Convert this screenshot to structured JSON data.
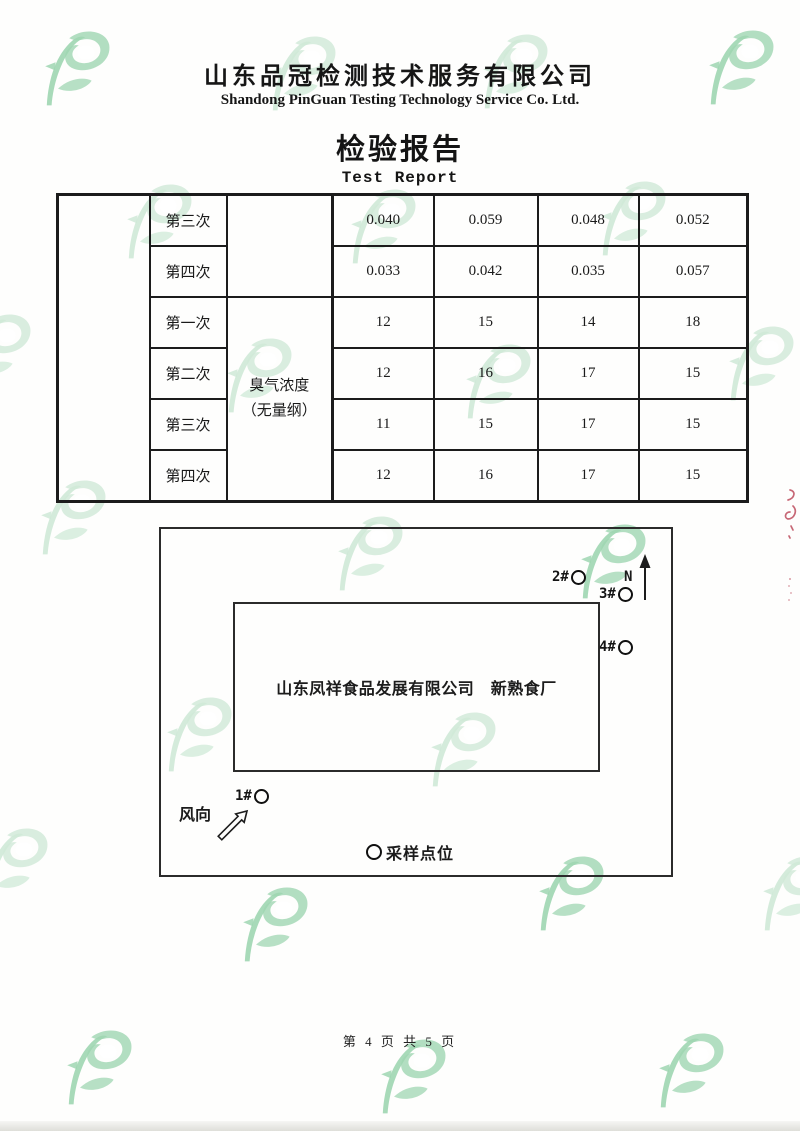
{
  "page": {
    "company_cn": "山东品冠检测技术服务有限公司",
    "company_en": "Shandong PinGuan Testing Technology Service Co. Ltd.",
    "title_cn": "检验报告",
    "title_en": "Test Report",
    "footer": "第 4 页 共 5 页"
  },
  "table": {
    "parameter_line1": "臭气浓度",
    "parameter_line2": "（无量纲）",
    "rows": [
      {
        "label": "第三次",
        "values": [
          "0.040",
          "0.059",
          "0.048",
          "0.052"
        ]
      },
      {
        "label": "第四次",
        "values": [
          "0.033",
          "0.042",
          "0.035",
          "0.057"
        ]
      },
      {
        "label": "第一次",
        "values": [
          "12",
          "15",
          "14",
          "18"
        ]
      },
      {
        "label": "第二次",
        "values": [
          "12",
          "16",
          "17",
          "15"
        ]
      },
      {
        "label": "第三次",
        "values": [
          "11",
          "15",
          "17",
          "15"
        ]
      },
      {
        "label": "第四次",
        "values": [
          "12",
          "16",
          "17",
          "15"
        ]
      }
    ]
  },
  "diagram": {
    "factory_label": "山东凤祥食品发展有限公司　新熟食厂",
    "north_label": "N",
    "wind_label": "风向",
    "legend_label": "采样点位",
    "points": [
      {
        "id": "1#"
      },
      {
        "id": "2#"
      },
      {
        "id": "3#"
      },
      {
        "id": "4#"
      }
    ]
  },
  "colors": {
    "watermark_green": "#9fd6b1",
    "text": "#1b1b1b",
    "red_edge_mark": "#b5374a"
  }
}
